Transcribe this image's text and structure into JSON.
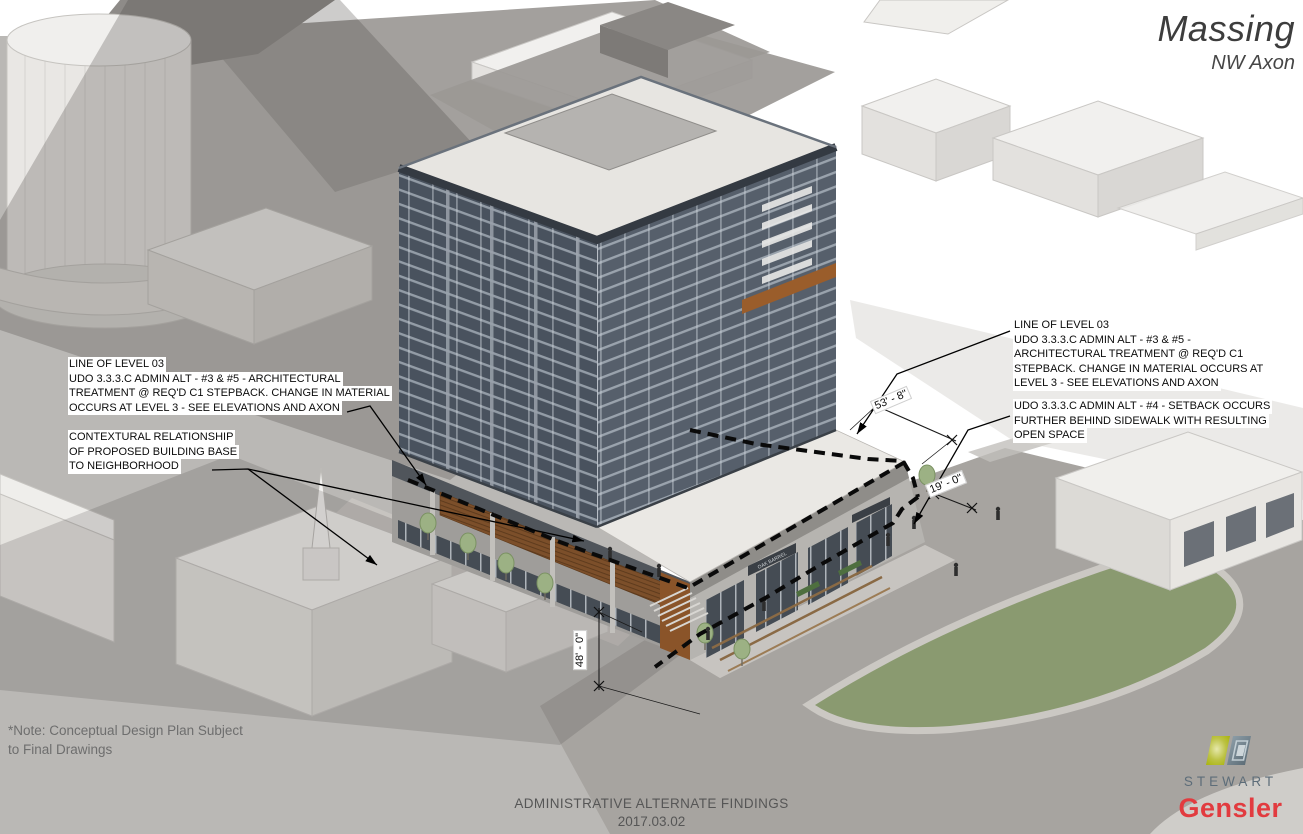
{
  "title": {
    "main": "Massing",
    "sub": "NW Axon"
  },
  "annotations": {
    "left_level03": {
      "lines": [
        "LINE OF LEVEL 03",
        "UDO 3.3.3.C ADMIN ALT - #3 & #5 - ARCHITECTURAL",
        "TREATMENT @ REQ'D C1 STEPBACK. CHANGE IN MATERIAL",
        "OCCURS AT LEVEL 3 - SEE ELEVATIONS AND AXON"
      ]
    },
    "context_relationship": {
      "lines": [
        "CONTEXTURAL RELATIONSHIP",
        "OF PROPOSED BUILDING BASE",
        "TO NEIGHBORHOOD"
      ]
    },
    "right_level03": {
      "lines": [
        "LINE OF LEVEL 03",
        "UDO 3.3.3.C ADMIN ALT - #3 & #5 -",
        "ARCHITECTURAL TREATMENT @ REQ'D C1",
        "STEPBACK. CHANGE IN MATERIAL OCCURS AT",
        "LEVEL 3 - SEE ELEVATIONS AND AXON"
      ]
    },
    "setback": {
      "lines": [
        "UDO 3.3.3.C ADMIN ALT - #4 - SETBACK OCCURS",
        "FURTHER BEHIND SIDEWALK WITH RESULTING",
        "OPEN SPACE"
      ]
    }
  },
  "dimensions": {
    "podium_depth": "53' - 8\"",
    "sidewalk_setback": "19' - 0\"",
    "street_frontage": "48' - 0\""
  },
  "storefront_sign": "OAK BARREL",
  "note": {
    "line1": "*Note: Conceptual Design Plan Subject",
    "line2": "to Final Drawings"
  },
  "footer": {
    "title": "ADMINISTRATIVE ALTERNATE FINDINGS",
    "date": "2017.03.02"
  },
  "branding": {
    "stewart_label": "STEWART",
    "gensler_label": "Gensler"
  },
  "colors": {
    "gensler_red": "#e23b3f",
    "stewart_slate": "#5d6d79",
    "stewart_green": "#a9b40c",
    "stewart_gray": "#6d7e88",
    "lawn_green": "#8a9a70",
    "tower_glass_dark": "#49525e",
    "tower_glass_light": "#565f6b",
    "wood_accent": "#7c4f2a",
    "dashed_line": "#0a0a0a"
  }
}
